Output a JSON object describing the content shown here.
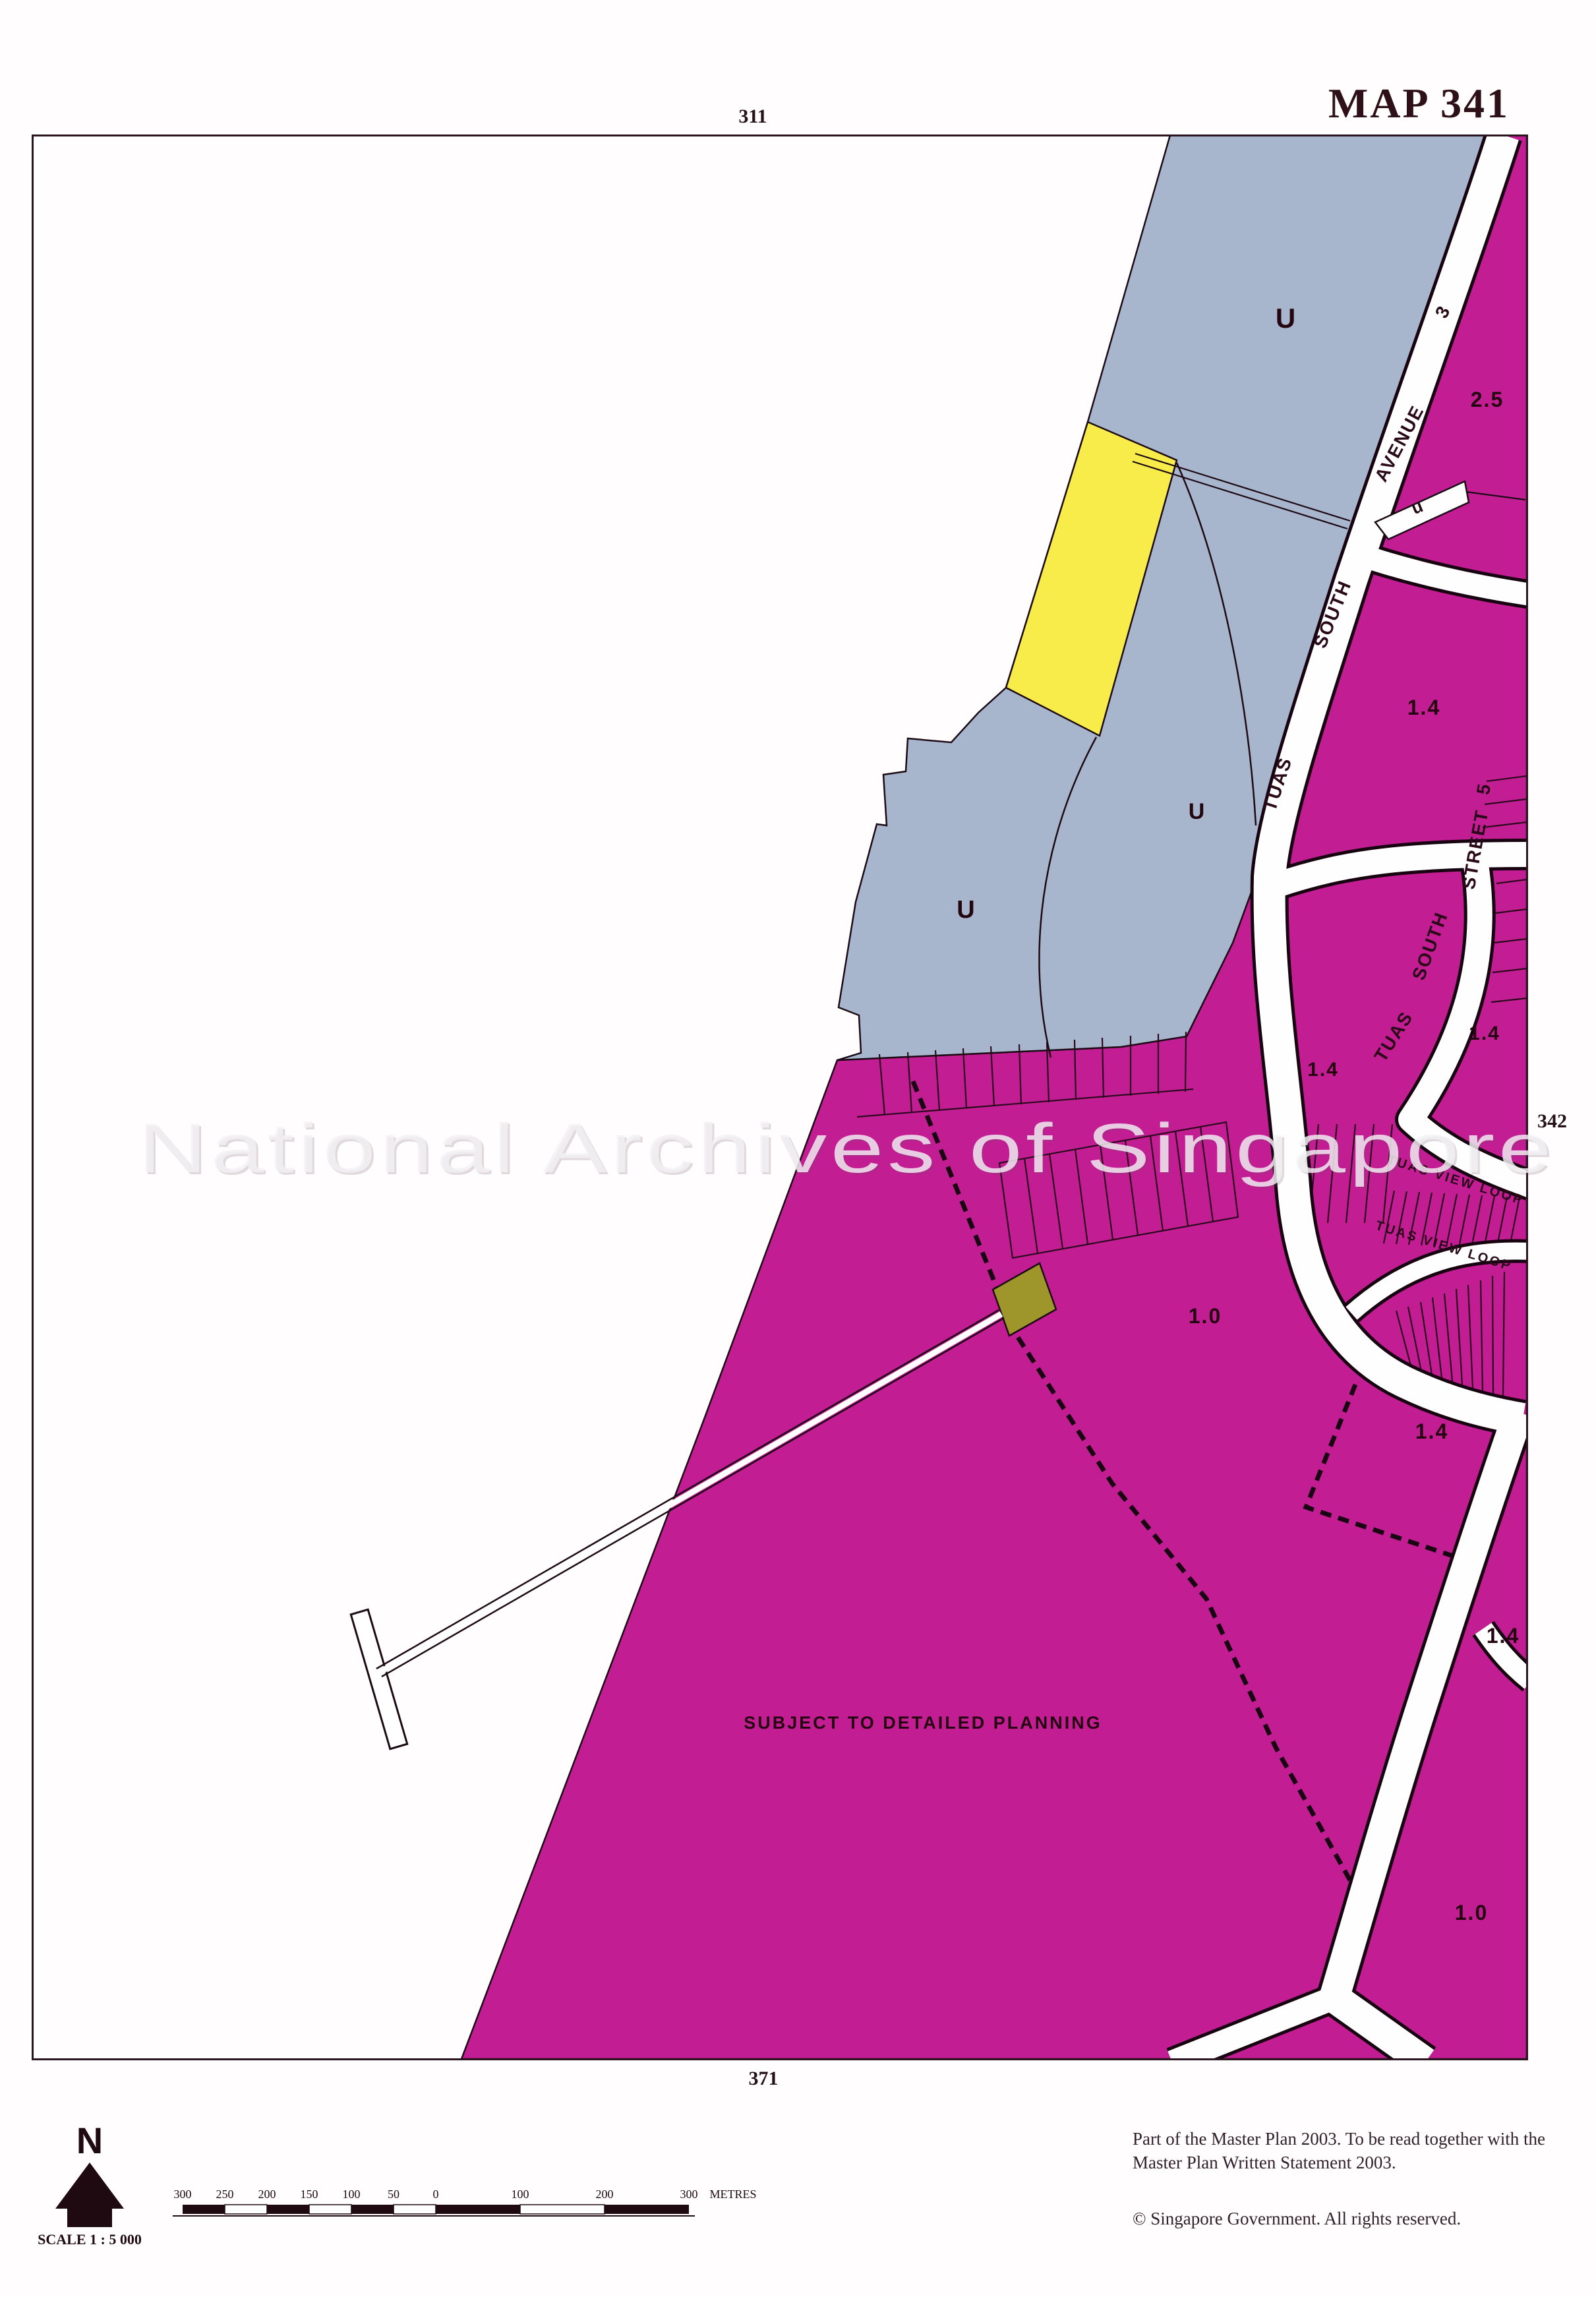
{
  "page": {
    "title": "MAP 341",
    "sheet_refs": {
      "top": "311",
      "bottom": "371",
      "right": "342"
    },
    "notes_line1": "Part of the Master Plan 2003.  To be read together  with  the",
    "notes_line2": "Master Plan Written Statement 2003.",
    "copyright": "©  Singapore Government.  All rights reserved.",
    "watermark": "National Archives of Singapore"
  },
  "compass": {
    "north_label": "N",
    "scale_label": "SCALE 1 : 5 000"
  },
  "scalebar": {
    "ticks": [
      "300",
      "250",
      "200",
      "150",
      "100",
      "50",
      "0",
      "100",
      "200",
      "300"
    ],
    "unit": "METRES"
  },
  "map": {
    "annotation": "SUBJECT TO DETAILED PLANNING",
    "road_labels": [
      {
        "text": "TUAS"
      },
      {
        "text": "SOUTH"
      },
      {
        "text": "AVENUE"
      },
      {
        "text": "3"
      },
      {
        "text": "TUAS"
      },
      {
        "text": "SOUTH"
      },
      {
        "text": "STREET"
      },
      {
        "text": "5"
      },
      {
        "text": "TUAS  VIEW  LOOP"
      },
      {
        "text": "TUAS  VIEW  LOOP"
      }
    ],
    "zone_labels": [
      {
        "text": "U"
      },
      {
        "text": "U"
      },
      {
        "text": "U"
      },
      {
        "text": "u"
      },
      {
        "text": "2.5"
      },
      {
        "text": "1.4"
      },
      {
        "text": "1.4"
      },
      {
        "text": "1.4"
      },
      {
        "text": "1.4"
      },
      {
        "text": "1.4"
      },
      {
        "text": "1.0"
      },
      {
        "text": "1.0"
      }
    ],
    "colors": {
      "industrial_magenta": "#c21d93",
      "utility_blue": "#a8b6cd",
      "reserve_yellow": "#f7ec4a",
      "special_olive": "#9e962b",
      "road_white": "#fefefe",
      "line_dark": "#1c0a14"
    }
  }
}
